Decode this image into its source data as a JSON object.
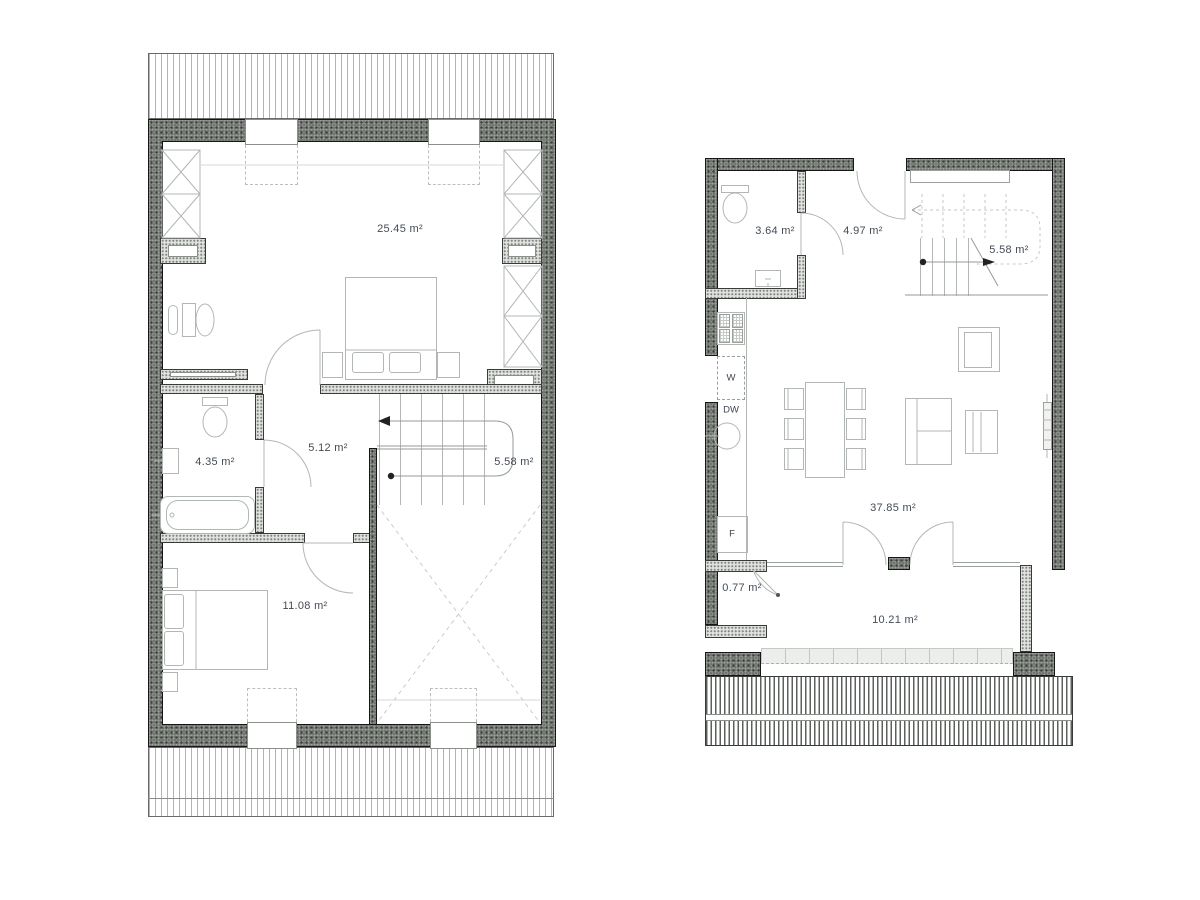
{
  "drawing": {
    "kind": "two-storey apartment floor plans",
    "palette": {
      "wall_dark": "#6e726d",
      "wall_light": "#dfe2de",
      "line": "#b3b7b4",
      "text": "#434c55"
    }
  },
  "plans": [
    {
      "name": "attic-floor-plan",
      "rooms": [
        {
          "name": "bedroom-1",
          "area": "25.45 m²"
        },
        {
          "name": "bathroom",
          "area": "4.35 m²"
        },
        {
          "name": "hall",
          "area": "5.12 m²"
        },
        {
          "name": "staircase",
          "area": "5.58 m²"
        },
        {
          "name": "bedroom-2",
          "area": "11.08 m²"
        }
      ]
    },
    {
      "name": "ground-floor-plan",
      "rooms": [
        {
          "name": "wc",
          "area": "3.64 m²"
        },
        {
          "name": "hallway",
          "area": "4.97 m²"
        },
        {
          "name": "staircase",
          "area": "5.58 m²"
        },
        {
          "name": "living-room-kitchen",
          "area": "37.85 m²"
        },
        {
          "name": "storage",
          "area": "0.77 m²"
        },
        {
          "name": "terrace",
          "area": "10.21 m²"
        }
      ],
      "appliance_labels": {
        "washer": "W",
        "dishwasher": "DW",
        "fridge": "F"
      }
    }
  ]
}
